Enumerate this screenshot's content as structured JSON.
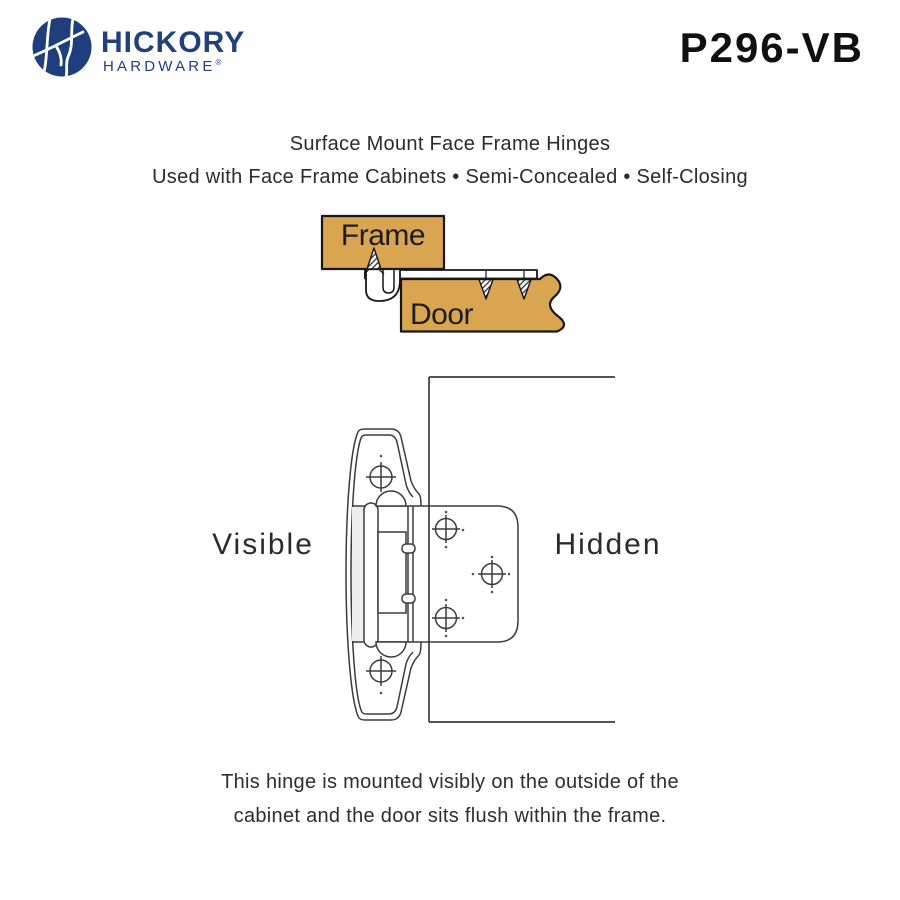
{
  "brand": {
    "line1": "HICKORY",
    "line2": "HARDWARE",
    "registered": "®"
  },
  "product_code": "P296-VB",
  "header": {
    "title": "Surface Mount Face Frame Hinges",
    "subtitle": "Used with Face Frame Cabinets • Semi-Concealed • Self-Closing"
  },
  "mount_diagram": {
    "frame_label": "Frame",
    "door_label": "Door"
  },
  "hinge_diagram": {
    "visible_label": "Visible",
    "hidden_label": "Hidden"
  },
  "caption": {
    "line1": "This hinge is mounted visibly on the outside of the",
    "line2": "cabinet and the door sits flush within the frame."
  },
  "colors": {
    "wood": "#D9A550",
    "wood_outline": "#161616",
    "line": "#3b3b3b",
    "brand_blue": "#1F3E7E"
  }
}
